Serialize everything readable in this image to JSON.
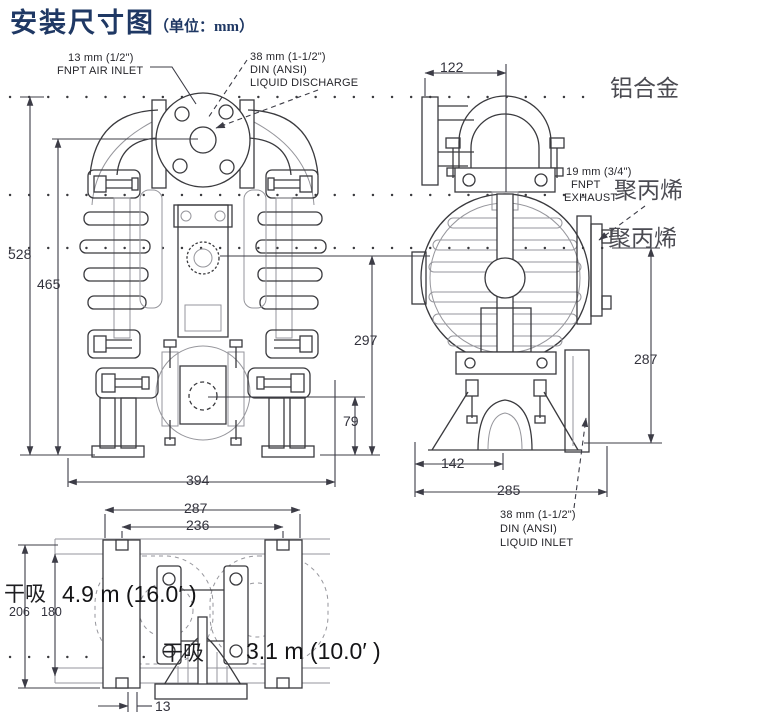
{
  "title": {
    "text": "安装尺寸图",
    "unit": "（单位：mm）"
  },
  "ports": {
    "air_inlet": {
      "line1": "13 mm (1/2\")",
      "line2": "FNPT AIR INLET"
    },
    "liquid_discharge": {
      "line1": "38 mm (1-1/2\")",
      "line2": "DIN (ANSI)",
      "line3": "LIQUID DISCHARGE"
    },
    "exhaust": {
      "line1": "19 mm (3/4\")",
      "line2": "FNPT",
      "line3": "EXHAUST"
    },
    "liquid_inlet": {
      "line1": "38 mm (1-1/2\")",
      "line2": "DIN (ANSI)",
      "line3": "LIQUID INLET"
    }
  },
  "materials": {
    "aluminum": "铝合金",
    "polypropylene_exhaust": "聚丙烯",
    "polypropylene_side": "聚丙烯"
  },
  "dims": {
    "front": {
      "total_height": "528",
      "air_inlet_height": "465",
      "width": "394",
      "exhaust_height": "297",
      "inlet_height": "79"
    },
    "side": {
      "clamp_width": "122",
      "height": "287",
      "foot_width": "142",
      "depth": "285"
    },
    "bottom": {
      "span_outer": "287",
      "span_inner": "236",
      "depth_outer": "206",
      "depth_inner": "180",
      "thickness": "13"
    }
  },
  "suction": {
    "primary": {
      "label": "干吸",
      "value": "4.9 m (16.0′ )"
    },
    "secondary": {
      "label": "干吸",
      "value": "3.1 m (10.0′ )"
    }
  }
}
